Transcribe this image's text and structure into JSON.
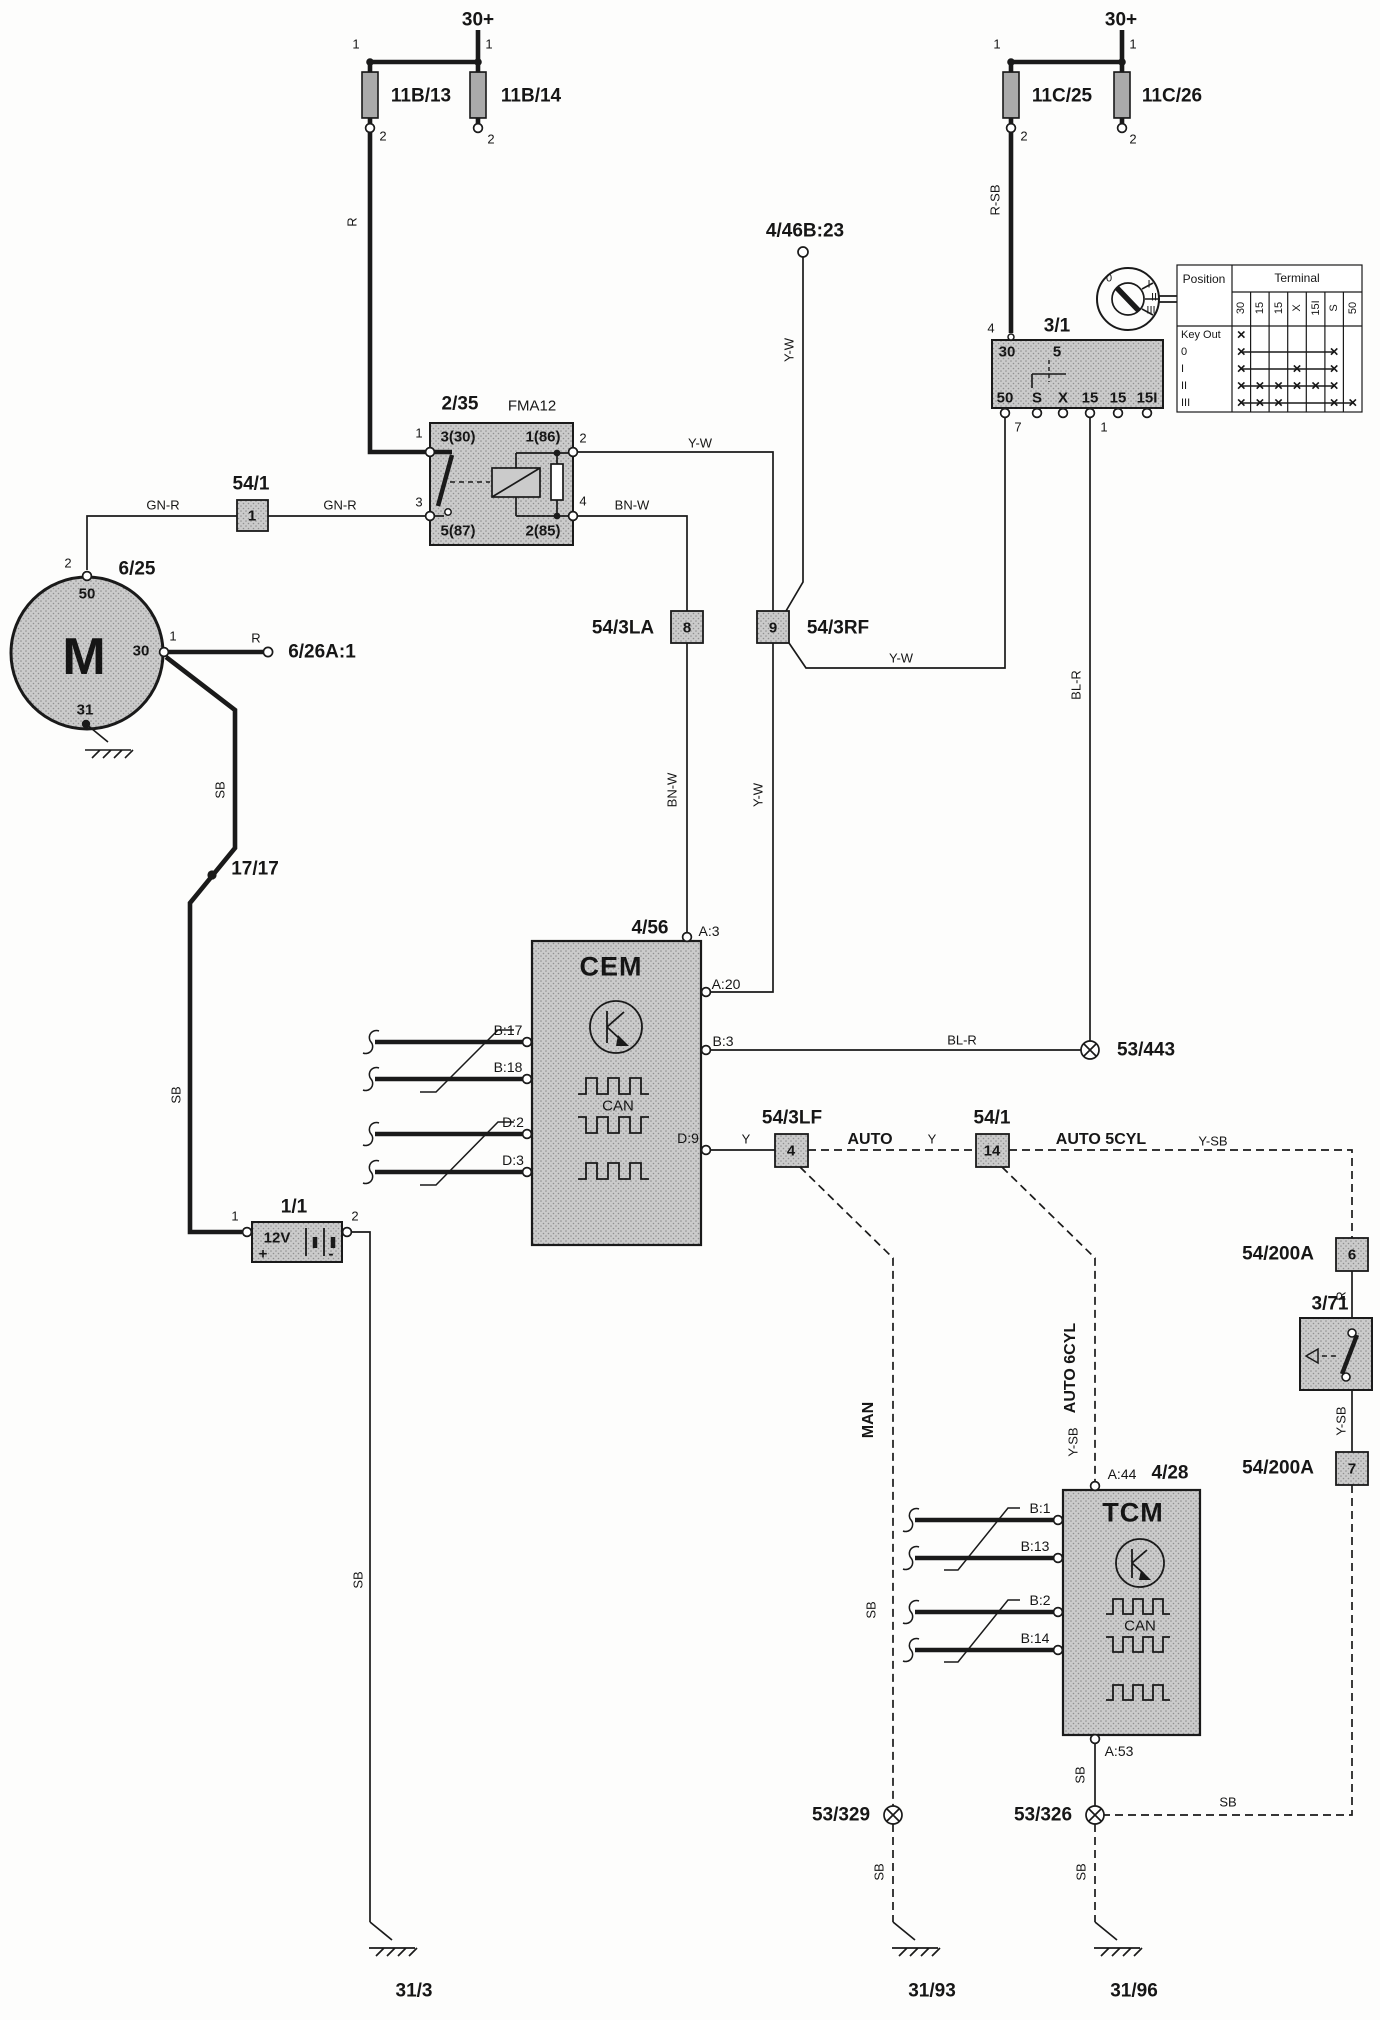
{
  "fuses_left": {
    "feed": "30+",
    "f1": "11B/13",
    "f2": "11B/14"
  },
  "fuses_right": {
    "feed": "30+",
    "f1": "11C/25",
    "f2": "11C/26"
  },
  "pins": {
    "n1": "1",
    "n2": "2",
    "n3": "3",
    "n4": "4",
    "n7": "7"
  },
  "wires": {
    "r": "R",
    "r_sb": "R-SB",
    "y_w": "Y-W",
    "bn_w": "BN-W",
    "gn_r": "GN-R",
    "sb": "SB",
    "bl_r": "BL-R",
    "y": "Y",
    "y_sb": "Y-SB"
  },
  "ignition_switch": {
    "id": "3/1",
    "t_30": "30",
    "t_5": "5",
    "bottom": [
      "50",
      "S",
      "X",
      "15",
      "15",
      "15I"
    ],
    "dial": [
      "0",
      "I",
      "II",
      "III"
    ]
  },
  "position_table": {
    "position": "Position",
    "terminal": "Terminal",
    "cols": [
      "30",
      "15",
      "15",
      "X",
      "15I",
      "S",
      "50"
    ],
    "rows": [
      "Key Out",
      "0",
      "I",
      "II",
      "III"
    ],
    "marks": [
      [
        0
      ],
      [
        0,
        5
      ],
      [
        0,
        3,
        5
      ],
      [
        0,
        1,
        2,
        3,
        4,
        5
      ],
      [
        0,
        1,
        2,
        5,
        6
      ]
    ],
    "mark_glyph": "×"
  },
  "relay": {
    "id": "2/35",
    "type": "FMA12",
    "t1": "3(30)",
    "t2": "1(86)",
    "t3": "5(87)",
    "t4": "2(85)"
  },
  "motor": {
    "id": "6/25",
    "sym": "M",
    "t50": "50",
    "t30": "30",
    "t31": "31"
  },
  "battery": {
    "id": "1/1",
    "v": "12V",
    "plus": "+",
    "minus": "-"
  },
  "connectors": {
    "c54_1a": "54/1",
    "c54_1a_pin": "1",
    "c54_3la": "54/3LA",
    "c54_3la_pin": "8",
    "c54_3rf": "54/3RF",
    "c54_3rf_pin": "9",
    "c54_3lf": "54/3LF",
    "c54_3lf_pin": "4",
    "c54_1b": "54/1",
    "c54_1b_pin": "14",
    "c54_200a": "54/200A",
    "c54_200a_p6": "6",
    "c54_200a_p7": "7",
    "c4_46b": "4/46B:23",
    "c6_26a": "6/26A:1"
  },
  "splices": {
    "s17": "17/17",
    "s53_443": "53/443",
    "s53_329": "53/329",
    "s53_326": "53/326"
  },
  "grounds": {
    "g31_3": "31/3",
    "g31_93": "31/93",
    "g31_96": "31/96"
  },
  "cem": {
    "id": "4/56",
    "name": "CEM",
    "bus": "CAN",
    "a3": "A:3",
    "a20": "A:20",
    "b17": "B:17",
    "b18": "B:18",
    "b3": "B:3",
    "d2": "D:2",
    "d3": "D:3",
    "d9": "D:9"
  },
  "tcm": {
    "id": "4/28",
    "name": "TCM",
    "bus": "CAN",
    "a44": "A:44",
    "a53": "A:53",
    "b1": "B:1",
    "b13": "B:13",
    "b2": "B:2",
    "b14": "B:14"
  },
  "pedal_switch": {
    "id": "3/71"
  },
  "variant_labels": {
    "auto": "AUTO",
    "auto_5cyl": "AUTO 5CYL",
    "auto_6cyl": "AUTO 6CYL",
    "man": "MAN"
  }
}
